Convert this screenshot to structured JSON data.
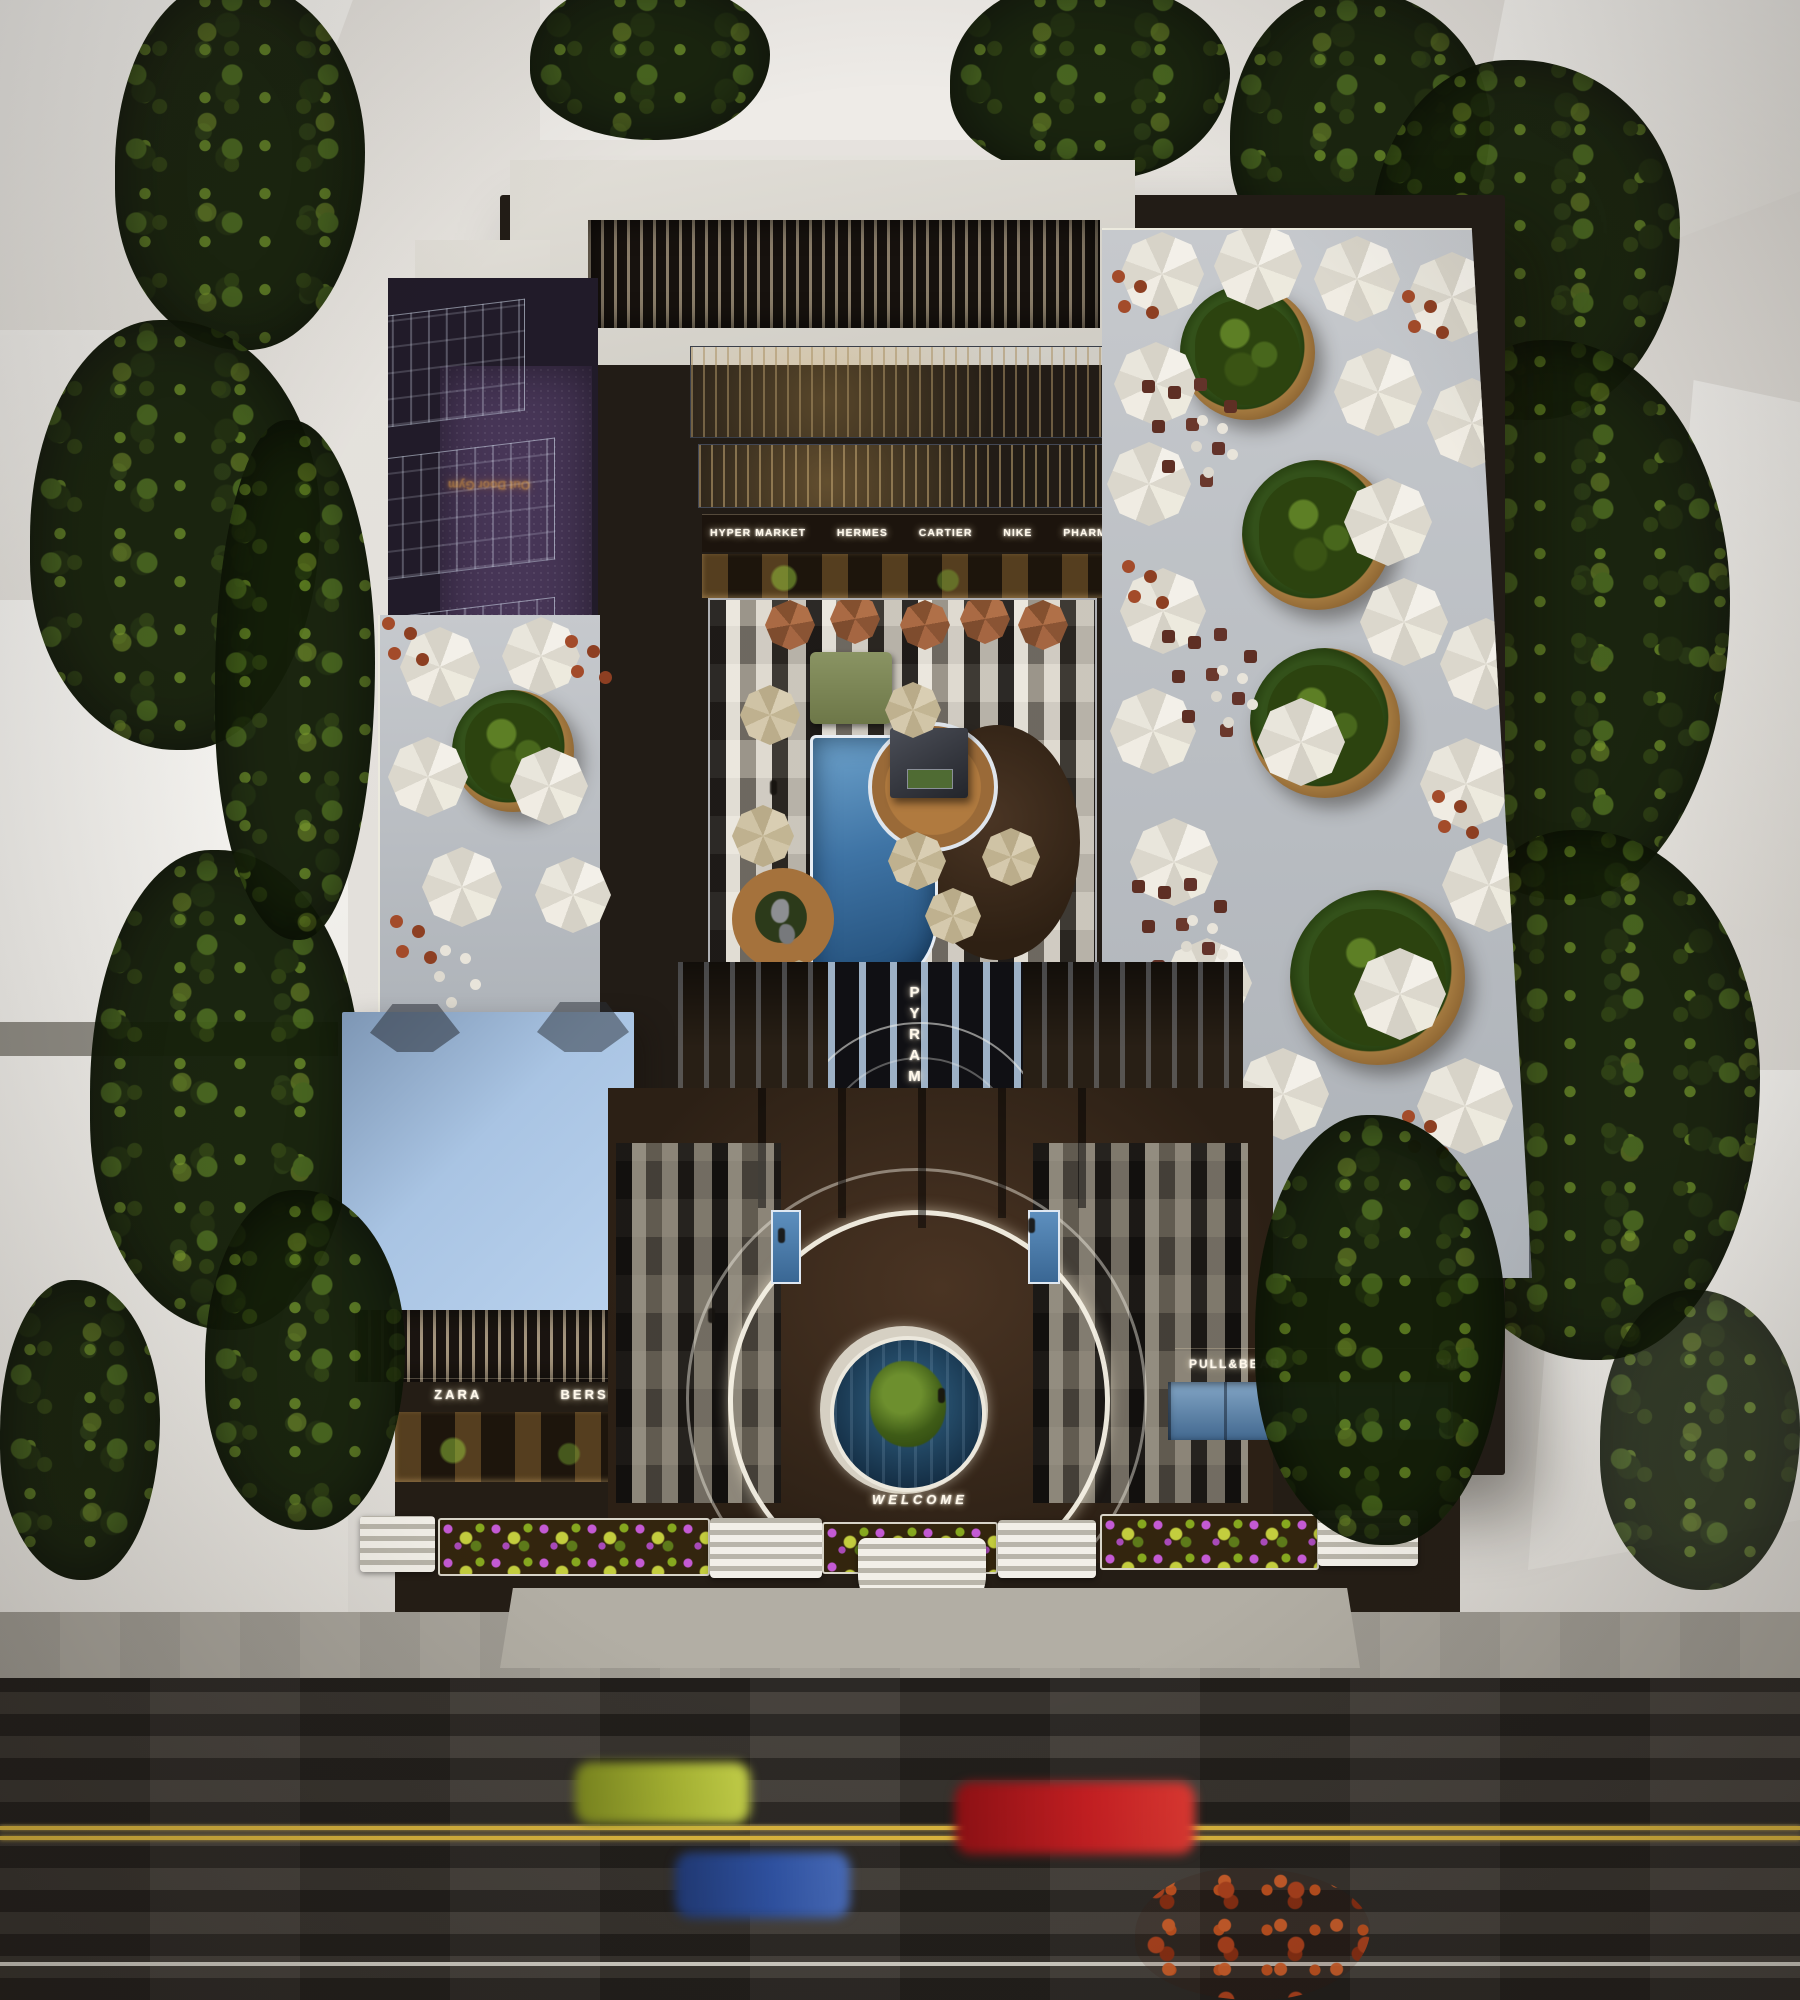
{
  "scene": {
    "description": "Aerial dusk 3D rendering of a rectangular shopping mall with rooftop cafe terraces, a central courtyard pool with kiosk, blue glass cube wing, and an illuminated circular entrance plaza facing a street with passing cars",
    "signs": {
      "gym": "Out Door Gym",
      "welcome": "WELCOME",
      "tower_vertical": "PYRAMID"
    },
    "storefronts_inner": [
      "HYPER MARKET",
      "HERMES",
      "CARTIER",
      "NIKE",
      "PHARMACY"
    ],
    "storefronts_front_left": [
      "ZARA",
      "BERSHKA"
    ],
    "storefronts_front_right": [
      "PULL&BEAR",
      "RM"
    ],
    "colors": {
      "blue_cube_roof": "#a9c4e3",
      "courtyard_pool": "#3f74a5",
      "purple_carpet": "#473657",
      "terrace_deck": "#b9bdc2",
      "road_asphalt": "#36322d",
      "lane_marking_yellow": "#dfb93f",
      "sign_glow_white": "#fff8ea",
      "gym_sign_orange": "#f6a93c",
      "car_red": "#c31e20",
      "car_blue": "#2f54a8",
      "car_yellow_green": "#97a42c"
    }
  }
}
